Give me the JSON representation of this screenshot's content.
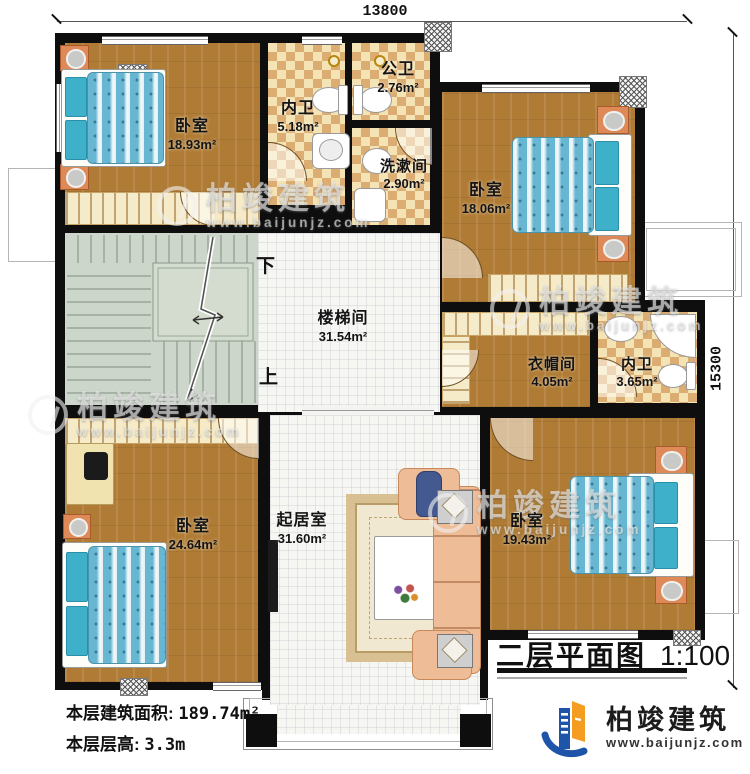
{
  "plan": {
    "title": "二层平面图",
    "scale": "1:100",
    "dim_top": "13800",
    "dim_right": "15300",
    "stair_down": "下",
    "stair_up": "上",
    "stats": {
      "area_label": "本层建筑面积:",
      "area_value": "189.74m²",
      "height_label": "本层层高:",
      "height_value": "3.3m"
    }
  },
  "rooms": [
    {
      "id": "bedroom-tl",
      "name": "卧室",
      "area": "18.93m²"
    },
    {
      "id": "bath-inner-top",
      "name": "内卫",
      "area": "5.18m²"
    },
    {
      "id": "bath-public",
      "name": "公卫",
      "area": "2.76m²"
    },
    {
      "id": "washroom",
      "name": "洗漱间",
      "area": "2.90m²"
    },
    {
      "id": "bedroom-tr",
      "name": "卧室",
      "area": "18.06m²"
    },
    {
      "id": "stairwell",
      "name": "楼梯间",
      "area": "31.54m²"
    },
    {
      "id": "cloakroom",
      "name": "衣帽间",
      "area": "4.05m²"
    },
    {
      "id": "bath-inner-right",
      "name": "内卫",
      "area": "3.65m²"
    },
    {
      "id": "bedroom-bl",
      "name": "卧室",
      "area": "24.64m²"
    },
    {
      "id": "living-room",
      "name": "起居室",
      "area": "31.60m²"
    },
    {
      "id": "bedroom-br",
      "name": "卧室",
      "area": "19.43m²"
    }
  ],
  "brand": {
    "name": "柏竣建筑",
    "site": "www.baijunjz.com"
  },
  "watermark": {
    "name": "柏竣建筑",
    "site": "www.baijunjz.com"
  },
  "colors": {
    "wall": "#0e0e0e",
    "wood_floor": "#b07c35",
    "tile_light": "#f4e3b5",
    "tile_dark": "#dcad72",
    "stair_floor": "#ccd6ca",
    "hall_tile": "#f6f6f2",
    "bed_blue": "#68b7d2",
    "pillow_teal": "#3fb0c9",
    "nightstand_orange": "#dd8a58",
    "sofa_peach": "#eebc97",
    "brand_blue": "#1e55a8",
    "brand_orange": "#f59d20"
  }
}
